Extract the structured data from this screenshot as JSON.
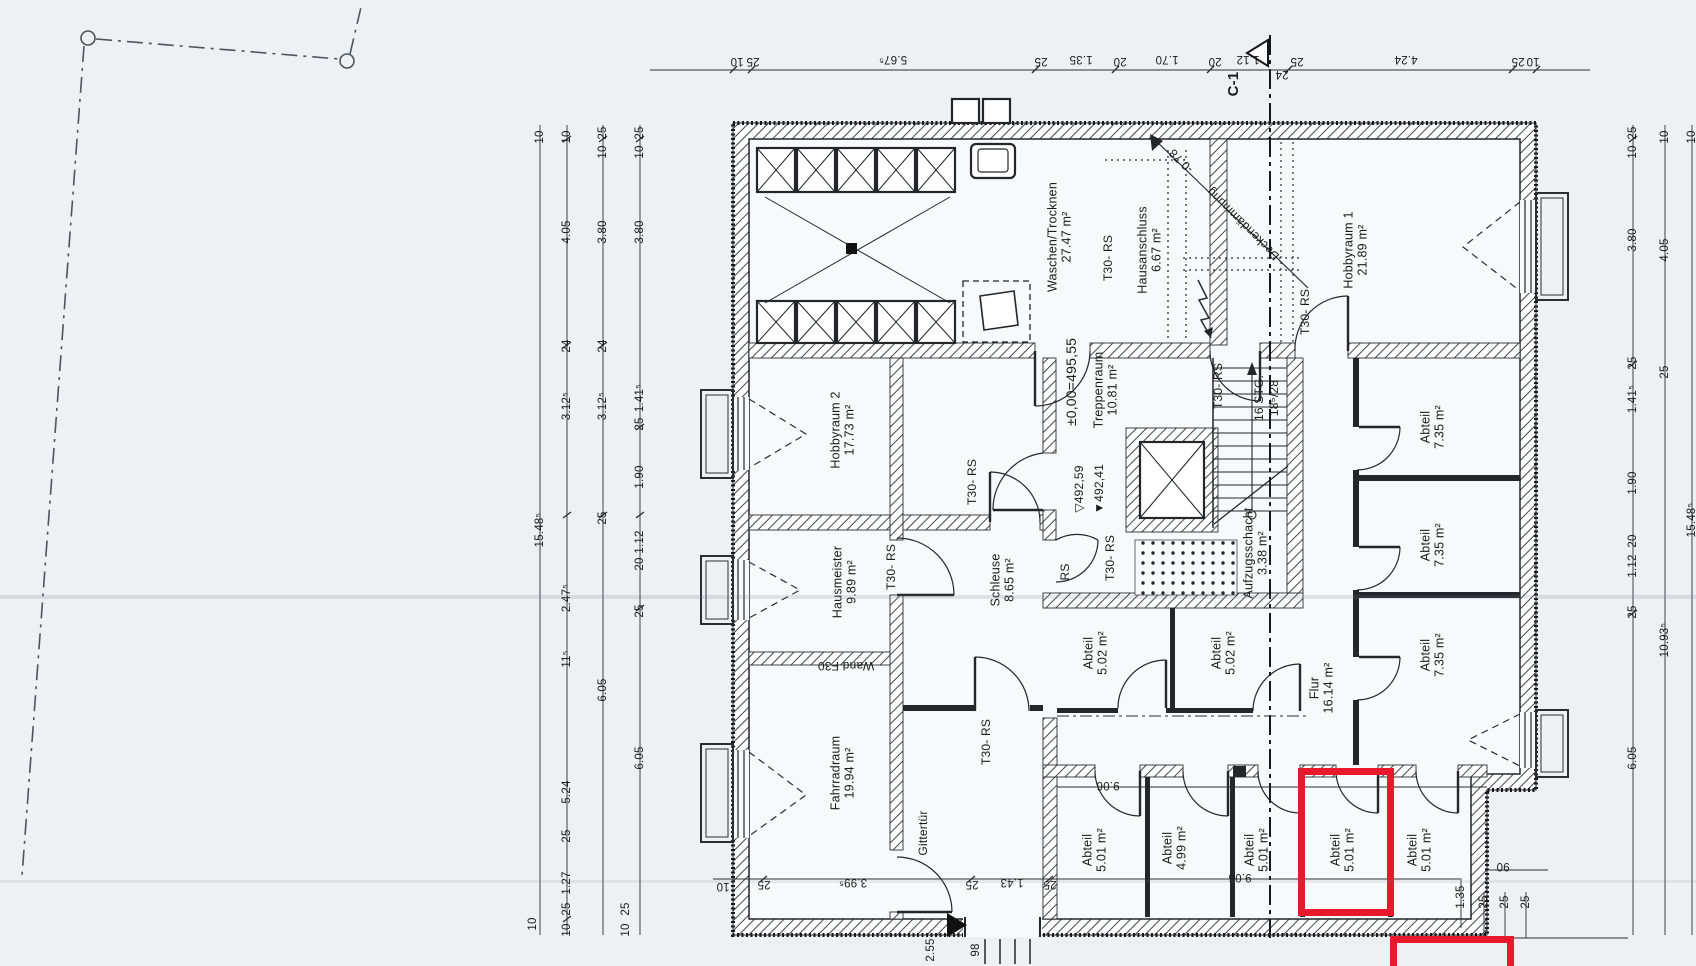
{
  "colors": {
    "paper": "#eef1f4",
    "floor": "#f7f9fb",
    "ink": "#1f1f1f",
    "highlight_red": "#e8192d"
  },
  "section": {
    "label": "C-1"
  },
  "rooms": [
    {
      "name": "Waschen/Trocknen",
      "area": "27.47 m²",
      "x": 1060,
      "y": 237,
      "rot": -90
    },
    {
      "name": "Hausanschluss",
      "area": "6.67 m²",
      "x": 1150,
      "y": 250,
      "rot": -90
    },
    {
      "name": "Hobbyraum 1",
      "area": "21.89 m²",
      "x": 1356,
      "y": 250,
      "rot": -90
    },
    {
      "name": "Hobbyraum 2",
      "area": "17.73 m²",
      "x": 843,
      "y": 430,
      "rot": -90
    },
    {
      "name": "Treppenraum",
      "area": "10.81 m²",
      "x": 1106,
      "y": 390,
      "rot": -90
    },
    {
      "name": "Hausmeister",
      "area": "9.89 m²",
      "x": 845,
      "y": 582,
      "rot": -90
    },
    {
      "name": "Schleuse",
      "area": "8.65 m²",
      "x": 1003,
      "y": 580,
      "rot": -90
    },
    {
      "name": "Aufzugsschacht",
      "area": "3.38 m²",
      "x": 1256,
      "y": 553,
      "rot": -90
    },
    {
      "name": "Fahrradraum",
      "area": "19.94 m²",
      "x": 843,
      "y": 773,
      "rot": -90
    },
    {
      "name": "Abteil",
      "area": "5.02 m²",
      "x": 1096,
      "y": 653,
      "rot": -90
    },
    {
      "name": "Abteil",
      "area": "5.02 m²",
      "x": 1224,
      "y": 653,
      "rot": -90
    },
    {
      "name": "Flur",
      "area": "16.14 m²",
      "x": 1322,
      "y": 688,
      "rot": -90
    },
    {
      "name": "Abteil",
      "area": "7.35 m²",
      "x": 1433,
      "y": 427,
      "rot": -90
    },
    {
      "name": "Abteil",
      "area": "7.35 m²",
      "x": 1433,
      "y": 545,
      "rot": -90
    },
    {
      "name": "Abteil",
      "area": "7.35 m²",
      "x": 1433,
      "y": 655,
      "rot": -90
    },
    {
      "name": "Abteil",
      "area": "5.01 m²",
      "x": 1095,
      "y": 850,
      "rot": -90
    },
    {
      "name": "Abteil",
      "area": "4.99 m²",
      "x": 1175,
      "y": 848,
      "rot": -90
    },
    {
      "name": "Abteil",
      "area": "5.01 m²",
      "x": 1257,
      "y": 850,
      "rot": -90
    },
    {
      "name": "Abteil",
      "area": "5.01 m²",
      "x": 1343,
      "y": 850,
      "rot": -90
    },
    {
      "name": "Abteil",
      "area": "5.01 m²",
      "x": 1420,
      "y": 850,
      "rot": -90
    }
  ],
  "door_labels": [
    {
      "text": "T30- RS",
      "x": 1108,
      "y": 258
    },
    {
      "text": "T30- RS",
      "x": 1305,
      "y": 312
    },
    {
      "text": "T30- RS",
      "x": 1218,
      "y": 386
    },
    {
      "text": "T30- RS",
      "x": 972,
      "y": 482
    },
    {
      "text": "T30- RS",
      "x": 891,
      "y": 567
    },
    {
      "text": "T30- RS",
      "x": 1110,
      "y": 558
    },
    {
      "text": "T30- RS",
      "x": 986,
      "y": 742
    },
    {
      "text": "RS",
      "x": 1065,
      "y": 572
    }
  ],
  "annotations": [
    {
      "text": "±0,00=495,55",
      "x": 1071,
      "y": 382,
      "rot": -90,
      "size": 14
    },
    {
      "text": "▽492,59",
      "x": 1079,
      "y": 489,
      "rot": -90
    },
    {
      "text": "▼492,41",
      "x": 1099,
      "y": 489,
      "rot": -90
    },
    {
      "text": "16 STG.",
      "x": 1259,
      "y": 398,
      "rot": -90
    },
    {
      "text": "18⁵/28",
      "x": 1274,
      "y": 398,
      "rot": -90
    },
    {
      "text": "Wand F30",
      "x": 846,
      "y": 666,
      "rot": 180
    },
    {
      "text": "Gittertür",
      "x": 923,
      "y": 833,
      "rot": -90
    },
    {
      "text": "Deckendämmung",
      "x": 1243,
      "y": 224,
      "rot": 225
    },
    {
      "text": "-0.78",
      "x": 1181,
      "y": 161,
      "rot": 225
    }
  ],
  "dim_labels": [
    {
      "t": "10",
      "x": 737,
      "y": 61,
      "rot": 180
    },
    {
      "t": "25",
      "x": 753,
      "y": 61,
      "rot": 180
    },
    {
      "t": "5.67⁵",
      "x": 893,
      "y": 59,
      "rot": 180
    },
    {
      "t": "25",
      "x": 1041,
      "y": 61,
      "rot": 180
    },
    {
      "t": "1.35",
      "x": 1081,
      "y": 59,
      "rot": 180
    },
    {
      "t": "20",
      "x": 1120,
      "y": 61,
      "rot": 180
    },
    {
      "t": "1.70",
      "x": 1167,
      "y": 59,
      "rot": 180
    },
    {
      "t": "20",
      "x": 1215,
      "y": 61,
      "rot": 180
    },
    {
      "t": "1.12",
      "x": 1248,
      "y": 59,
      "rot": 180
    },
    {
      "t": "24",
      "x": 1282,
      "y": 74,
      "rot": 180
    },
    {
      "t": "25",
      "x": 1297,
      "y": 61,
      "rot": 180
    },
    {
      "t": "4.24",
      "x": 1406,
      "y": 59,
      "rot": 180
    },
    {
      "t": "25",
      "x": 1518,
      "y": 61,
      "rot": 180
    },
    {
      "t": "10",
      "x": 1533,
      "y": 61,
      "rot": 180
    },
    {
      "t": "10",
      "x": 540,
      "y": 137
    },
    {
      "t": "15.48⁵",
      "x": 540,
      "y": 530
    },
    {
      "t": "10",
      "x": 533,
      "y": 924
    },
    {
      "t": "10",
      "x": 567,
      "y": 137
    },
    {
      "t": "4.05",
      "x": 567,
      "y": 232
    },
    {
      "t": "24",
      "x": 567,
      "y": 346
    },
    {
      "t": "3.12⁵",
      "x": 567,
      "y": 406
    },
    {
      "t": "2.47⁵",
      "x": 567,
      "y": 598
    },
    {
      "t": "11⁵",
      "x": 567,
      "y": 659
    },
    {
      "t": "5.24",
      "x": 567,
      "y": 792
    },
    {
      "t": "25",
      "x": 567,
      "y": 836
    },
    {
      "t": "1.27",
      "x": 567,
      "y": 883
    },
    {
      "t": "25",
      "x": 567,
      "y": 909
    },
    {
      "t": "10",
      "x": 567,
      "y": 930
    },
    {
      "t": "25",
      "x": 603,
      "y": 133
    },
    {
      "t": "10",
      "x": 603,
      "y": 152
    },
    {
      "t": "3.80",
      "x": 603,
      "y": 232
    },
    {
      "t": "24",
      "x": 603,
      "y": 346
    },
    {
      "t": "3.12⁵",
      "x": 603,
      "y": 406
    },
    {
      "t": "25",
      "x": 603,
      "y": 518
    },
    {
      "t": "6.05",
      "x": 603,
      "y": 690
    },
    {
      "t": "25",
      "x": 626,
      "y": 909
    },
    {
      "t": "10",
      "x": 626,
      "y": 930
    },
    {
      "t": "25",
      "x": 640,
      "y": 133
    },
    {
      "t": "10",
      "x": 640,
      "y": 152
    },
    {
      "t": "3.80",
      "x": 640,
      "y": 232
    },
    {
      "t": "1.41⁵",
      "x": 640,
      "y": 398
    },
    {
      "t": "25",
      "x": 640,
      "y": 424
    },
    {
      "t": "1.90",
      "x": 640,
      "y": 477
    },
    {
      "t": "1.12",
      "x": 640,
      "y": 542
    },
    {
      "t": "20",
      "x": 640,
      "y": 564
    },
    {
      "t": "25",
      "x": 640,
      "y": 611
    },
    {
      "t": "6.05",
      "x": 640,
      "y": 758
    },
    {
      "t": "25",
      "x": 1633,
      "y": 133
    },
    {
      "t": "10",
      "x": 1633,
      "y": 152
    },
    {
      "t": "3.80",
      "x": 1633,
      "y": 240
    },
    {
      "t": "25",
      "x": 1633,
      "y": 363
    },
    {
      "t": "1.41⁵",
      "x": 1633,
      "y": 399
    },
    {
      "t": "1.90",
      "x": 1633,
      "y": 483
    },
    {
      "t": "20",
      "x": 1633,
      "y": 541
    },
    {
      "t": "1.12",
      "x": 1633,
      "y": 566
    },
    {
      "t": "25",
      "x": 1633,
      "y": 612
    },
    {
      "t": "6.05",
      "x": 1633,
      "y": 758
    },
    {
      "t": "10",
      "x": 1665,
      "y": 137
    },
    {
      "t": "4.05",
      "x": 1665,
      "y": 250
    },
    {
      "t": "25",
      "x": 1665,
      "y": 372
    },
    {
      "t": "10.93⁵",
      "x": 1665,
      "y": 640
    },
    {
      "t": "10",
      "x": 1692,
      "y": 137
    },
    {
      "t": "15.48⁵",
      "x": 1692,
      "y": 520
    },
    {
      "t": "10",
      "x": 723,
      "y": 886,
      "rot": 180
    },
    {
      "t": "25",
      "x": 764,
      "y": 884,
      "rot": 180
    },
    {
      "t": "3.99⁵",
      "x": 853,
      "y": 882,
      "rot": 180
    },
    {
      "t": "25",
      "x": 972,
      "y": 884,
      "rot": 180
    },
    {
      "t": "1.43",
      "x": 1012,
      "y": 882,
      "rot": 180
    },
    {
      "t": "25",
      "x": 1050,
      "y": 884,
      "rot": 180
    },
    {
      "t": "9.06",
      "x": 1108,
      "y": 785,
      "rot": 180
    },
    {
      "t": "9.06",
      "x": 1240,
      "y": 877,
      "rot": 180
    },
    {
      "t": "90",
      "x": 1503,
      "y": 866,
      "rot": 180
    },
    {
      "t": "1.35",
      "x": 1461,
      "y": 897
    },
    {
      "t": "25",
      "x": 1484,
      "y": 902
    },
    {
      "t": "25",
      "x": 1505,
      "y": 902
    },
    {
      "t": "25",
      "x": 1526,
      "y": 902
    },
    {
      "t": "2.55",
      "x": 931,
      "y": 950
    },
    {
      "t": "98",
      "x": 976,
      "y": 950
    }
  ]
}
